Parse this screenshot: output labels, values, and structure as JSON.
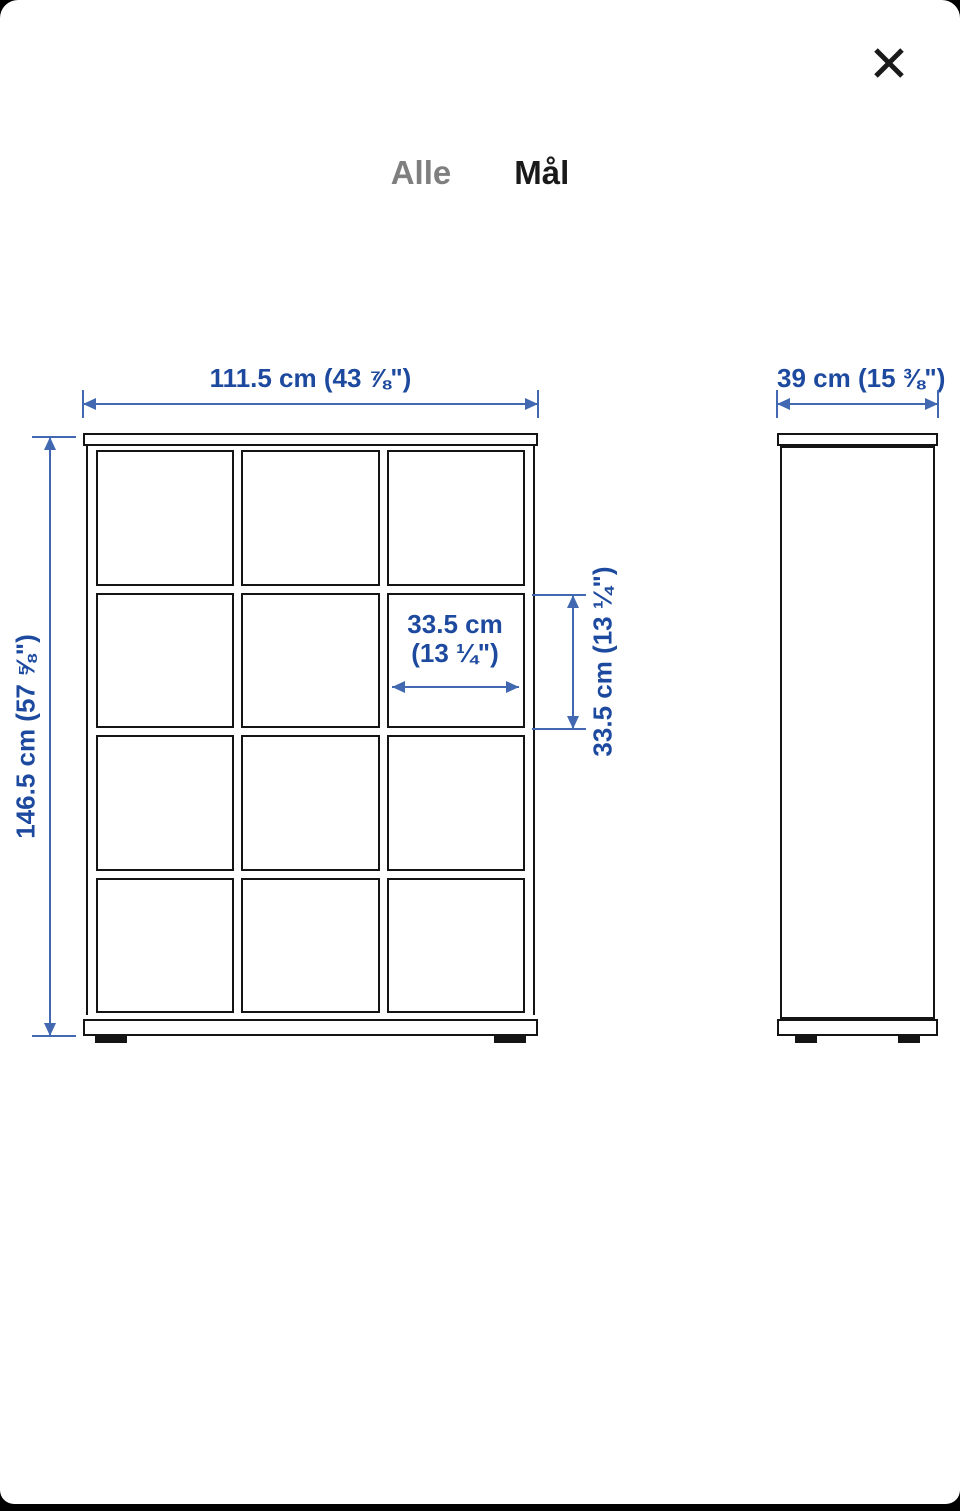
{
  "colors": {
    "dimension_text_blue": "#1d4a9f",
    "dimension_line_blue": "#4168b1",
    "drawing_line_black": "#141414",
    "inactive_tab_gray": "#7f7f7f"
  },
  "header": {
    "close_icon": "close-x",
    "tabs": [
      {
        "label": "Alle",
        "active": false
      },
      {
        "label": "Mål",
        "active": true
      }
    ]
  },
  "diagram": {
    "front_view": {
      "rows": 4,
      "columns": 3,
      "width_label": "111.5 cm (43 ⅞\")",
      "height_label": "146.5 cm (57 ⅝\")",
      "cube_width_label_line1": "33.5 cm",
      "cube_width_label_line2": "(13 ¼\")",
      "cube_height_label": "33.5 cm (13 ¼\")"
    },
    "side_view": {
      "depth_label": "39 cm (15 ⅜\")"
    }
  }
}
